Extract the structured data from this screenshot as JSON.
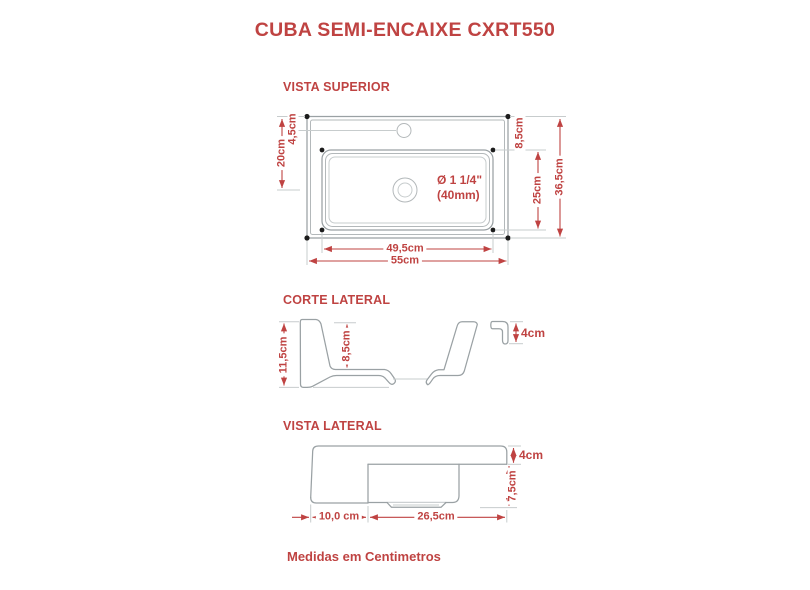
{
  "title": "CUBA SEMI-ENCAIXE CXRT550",
  "footer": "Medidas em Centimetros",
  "colors": {
    "accent": "#bf4342",
    "line": "#9aa1a4",
    "line_mid": "#b3b8ba",
    "line_light": "#c7cccd",
    "dot": "#1c1c1c"
  },
  "views": {
    "top": {
      "label": "VISTA SUPERIOR",
      "dims": {
        "faucet_offset": "4,5cm",
        "drain_center_offset": "20cm",
        "basin_top_offset": "8,5cm",
        "basin_depth": "25cm",
        "total_depth": "36,5cm",
        "basin_width": "49,5cm",
        "total_width": "55cm"
      },
      "drain_label_line1": "Ø 1 1/4\"",
      "drain_label_line2": "(40mm)"
    },
    "section": {
      "label": "CORTE LATERAL",
      "dims": {
        "total_height": "11,5cm",
        "basin_depth": "8,5cm",
        "rim_height": "4cm"
      }
    },
    "side": {
      "label": "VISTA LATERAL",
      "dims": {
        "rim_height": "4cm",
        "body_depth": "7,5cm",
        "front_overhang": "10,0 cm",
        "basin_length": "26,5cm"
      }
    }
  }
}
